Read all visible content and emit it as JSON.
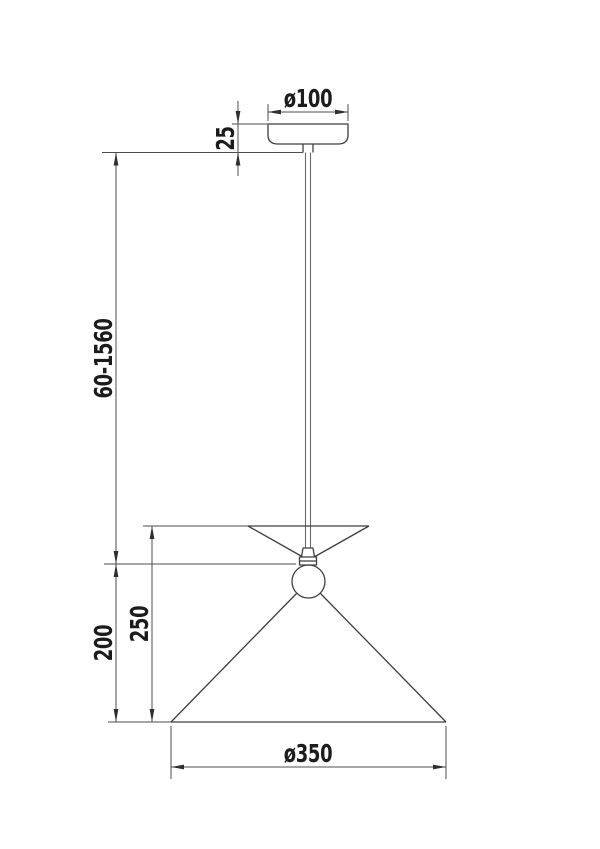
{
  "drawing": {
    "title": "pendant-lamp-dimension-drawing",
    "colors": {
      "background": "#ffffff",
      "object_line": "#3f3f3f",
      "dimension_line": "#4d4d4d",
      "label_text": "#1c1c1c"
    },
    "labels": {
      "canopy_diameter": "ø100",
      "canopy_height": "25",
      "suspension_length": "60-1560",
      "shade_total_height": "250",
      "lower_section_height": "200",
      "shade_diameter": "ø350"
    }
  }
}
